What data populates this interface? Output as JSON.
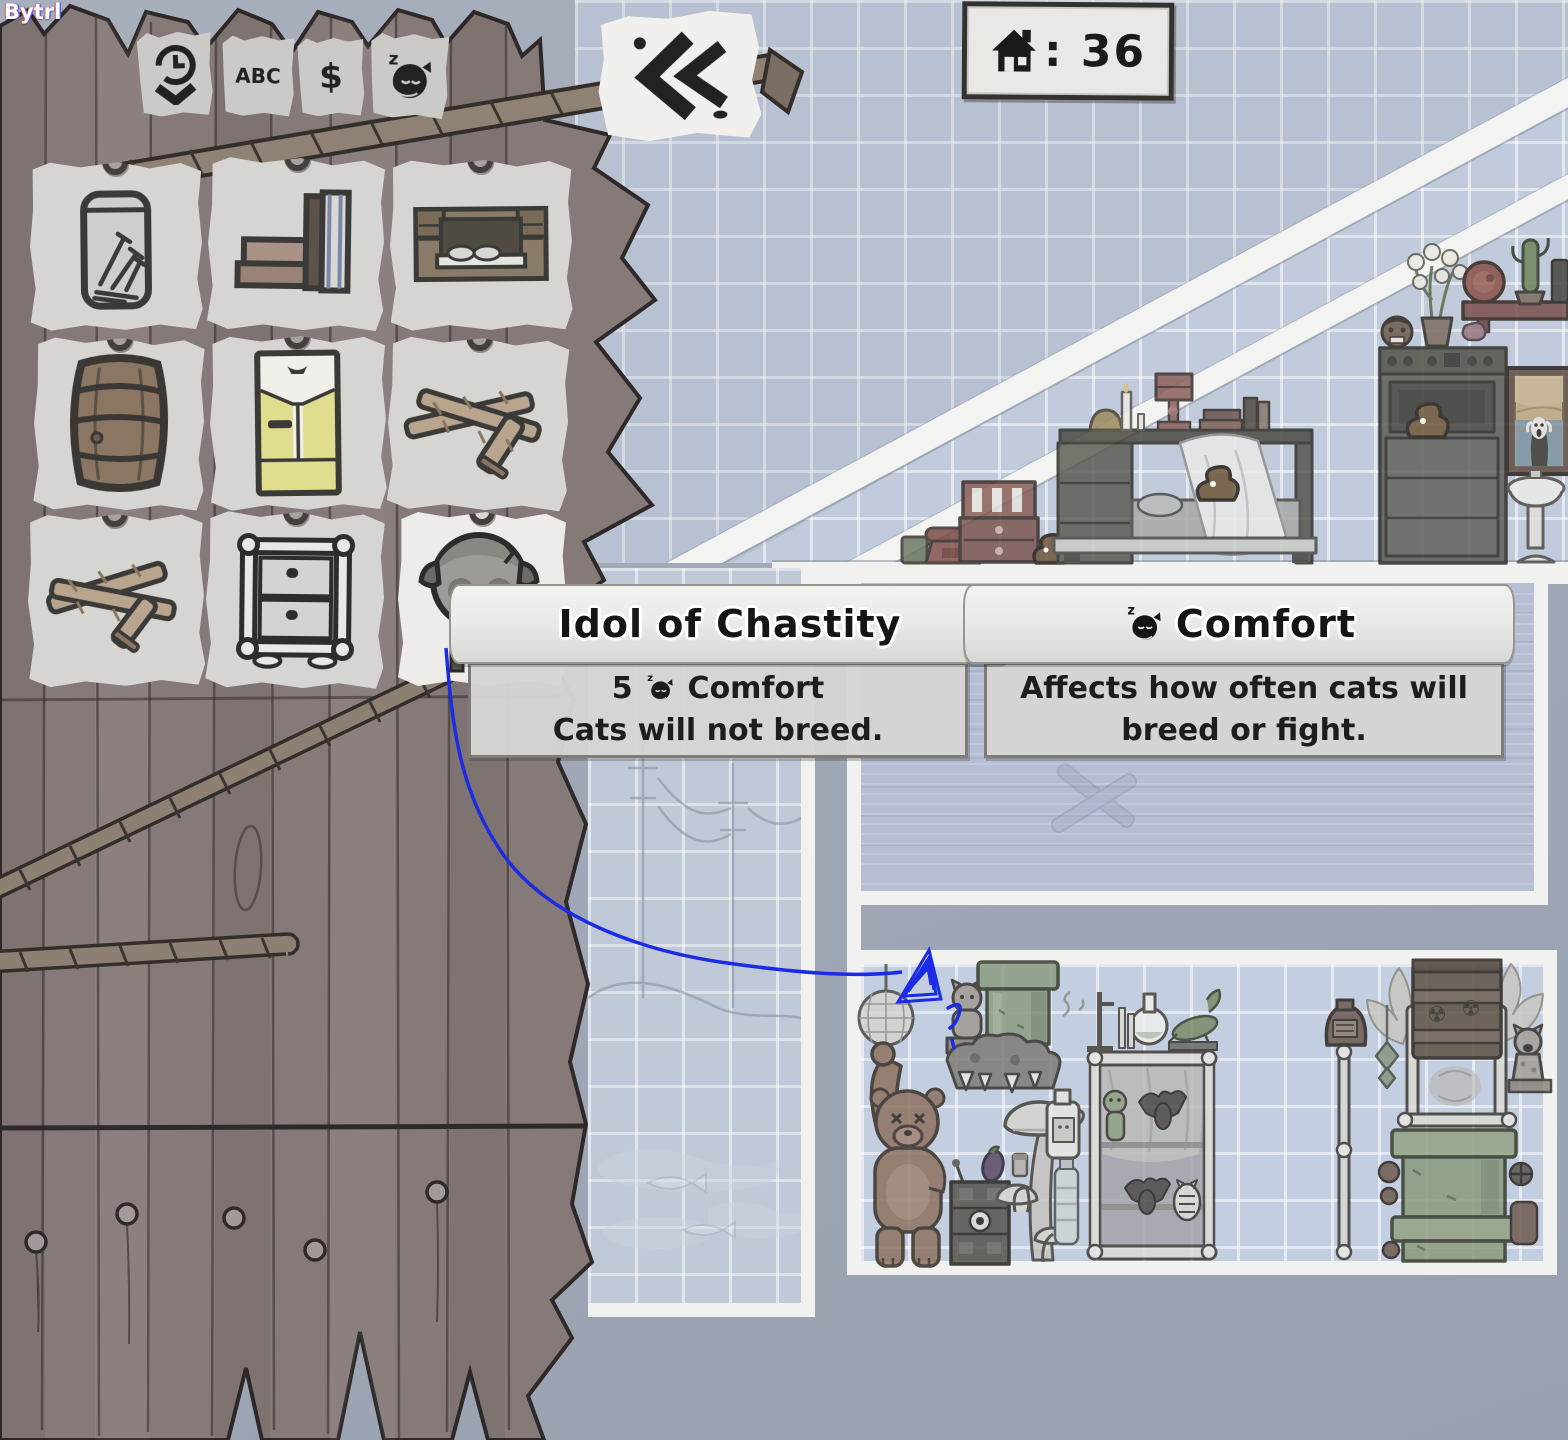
{
  "watermark": "Bytrl",
  "hud": {
    "house_capacity_icon": "house-icon",
    "house_count": 36,
    "house_count_display": ": 36"
  },
  "catalog": {
    "sort_tabs": [
      {
        "id": "recent",
        "icon": "history-sort-icon",
        "label": ""
      },
      {
        "id": "alphabetical",
        "icon": "abc-sort-icon",
        "label": "ABC"
      },
      {
        "id": "price",
        "icon": "price-sort-icon",
        "label": "$"
      },
      {
        "id": "comfort",
        "icon": "comfort-sort-icon",
        "label": ""
      }
    ],
    "collapse_button_icon": "collapse-panel-icon",
    "items": [
      {
        "name": "jar-of-nails"
      },
      {
        "name": "books"
      },
      {
        "name": "wall-bed"
      },
      {
        "name": "barrel"
      },
      {
        "name": "refrigerator"
      },
      {
        "name": "wood-planks"
      },
      {
        "name": "wood-planks-alt"
      },
      {
        "name": "bone-dresser"
      },
      {
        "name": "idol-of-chastity",
        "selected": true
      }
    ]
  },
  "tooltips": {
    "item": {
      "title": "Idol of Chastity",
      "stat_value": "5",
      "stat_icon": "comfort-cat-icon",
      "stat_name": "Comfort",
      "description": "Cats will not breed."
    },
    "stat": {
      "icon": "comfort-cat-icon",
      "title": "Comfort",
      "description": "Affects how often cats will breed or fight."
    }
  },
  "rooms": {
    "upper": {
      "furniture": [
        "mug",
        "telephone",
        "toy-dresser",
        "poop",
        "bed-with-shelf",
        "bell",
        "candle",
        "cake-stand",
        "books",
        "poop-on-bed",
        "stove",
        "poop-on-stove",
        "shrunken-head",
        "flower-pot",
        "wall-shelf",
        "cheese-wheel",
        "potted-cactus",
        "scream-painting",
        "pink-vase",
        "pedestal-sink"
      ]
    },
    "middle": {
      "furniture": [
        "faint-crossed-planks"
      ]
    },
    "stairwell": {
      "decor": [
        "ghost-landscape-sketch",
        "ghost-fish"
      ]
    },
    "lower": {
      "furniture": [
        "disco-ball",
        "cat-gargoyle-statue",
        "warp-pipe",
        "rock-pile",
        "teddy-bear",
        "eggplant",
        "jar",
        "robot-dresser",
        "mushroom-lamps",
        "milk-jug",
        "water-bottle",
        "bone-display-case",
        "zombie-doll",
        "bats",
        "skeleton-cat",
        "lab-flask",
        "alligator-figure",
        "bone-pole-with-jug",
        "moth-wings",
        "radioactive-barrel-shrine",
        "hanging-charm",
        "cat-statue",
        "pipe-stack"
      ]
    }
  },
  "cursor": {
    "style": "scribbled-pyramid-with-question-mark",
    "color": "#1b2ce4"
  },
  "colors": {
    "background": "#a2aab9",
    "fence_wood": "#867a79",
    "blueprint_wall": "#c2cbdb",
    "plank_wall": "#b7bed4",
    "paper": "#d6d5d1",
    "paper_selected": "#edece8",
    "ink": "#1c1b19",
    "accent_blue": "#1b2ce4",
    "poop_brown": "#6f5638"
  }
}
